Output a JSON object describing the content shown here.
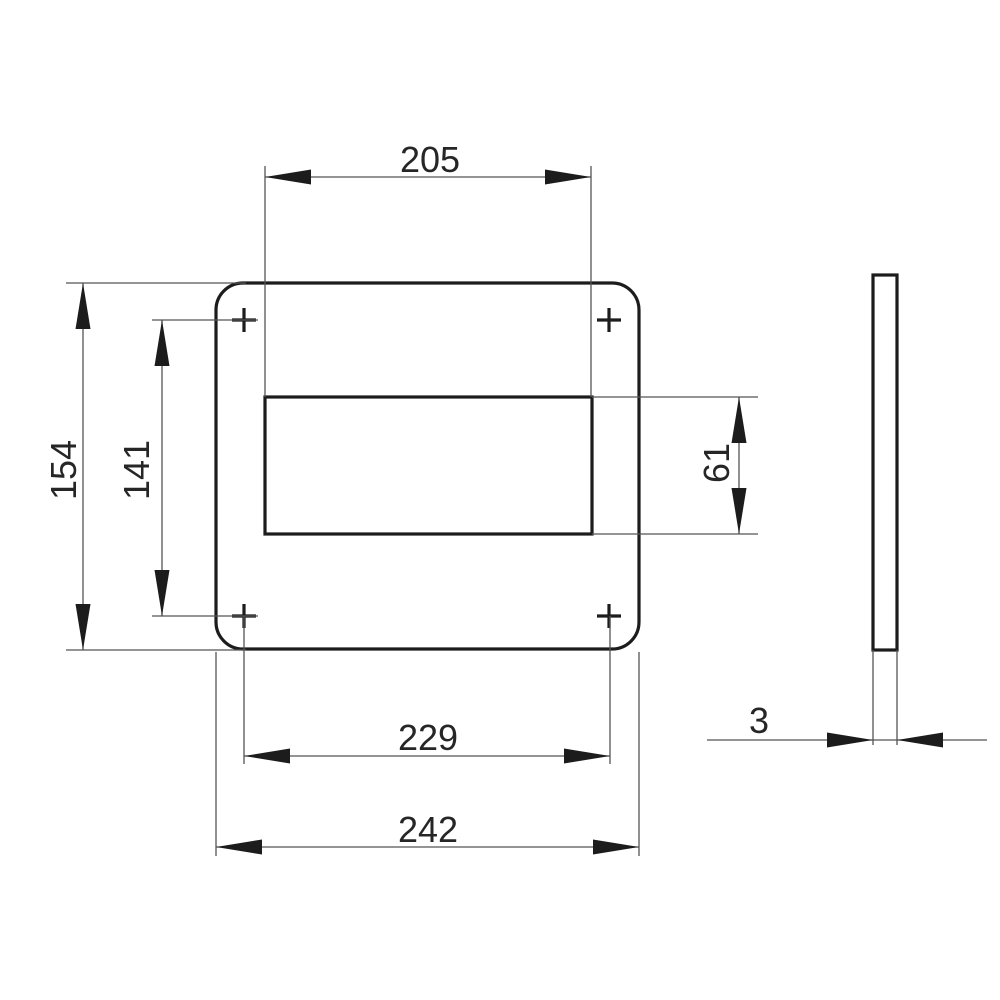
{
  "drawing": {
    "type": "technical-drawing",
    "views": {
      "front": {
        "dimensions": {
          "cutout_width": "205",
          "overall_height": "154",
          "hole_spacing_vertical": "141",
          "cutout_height": "61",
          "hole_spacing_horizontal": "229",
          "overall_width": "242"
        }
      },
      "side": {
        "dimensions": {
          "thickness": "3"
        }
      }
    },
    "colors": {
      "outline": "#1c1c1c",
      "dimension_line": "#555555",
      "text": "#262626",
      "background": "#ffffff"
    }
  }
}
